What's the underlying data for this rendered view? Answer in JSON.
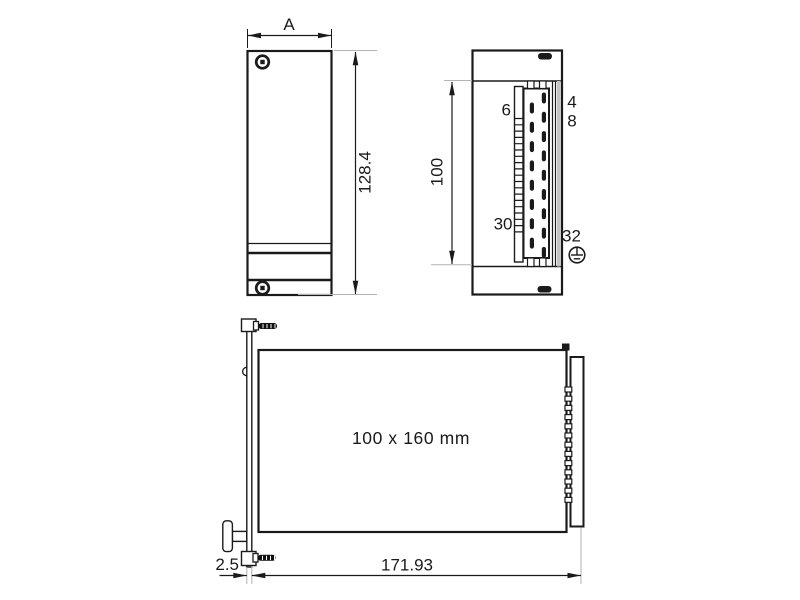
{
  "drawing": {
    "front_view": {
      "width_label": "A",
      "height_label": "128.4"
    },
    "side_view": {
      "height_label": "100",
      "pin_labels": {
        "upper_left": "6",
        "lower_left": "30",
        "upper_right_row1": "4",
        "upper_right_row2": "8",
        "lower_right": "32"
      },
      "pin_rows": {
        "left_count": 8,
        "right_count": 9
      },
      "contact_hatch_count": 19,
      "icons": {
        "ground": "earth-ground-icon"
      }
    },
    "bottom_view": {
      "board_label": "100 x 160 mm",
      "length_label": "171.93",
      "panel_thickness_label": "2.5",
      "pin_count": 13
    },
    "colors": {
      "line": "#1a1a1a",
      "extension_line": "#b3b3b3",
      "background": "#ffffff",
      "screw_fill": "#111111",
      "rail_fill": "#c4c4c4"
    }
  }
}
